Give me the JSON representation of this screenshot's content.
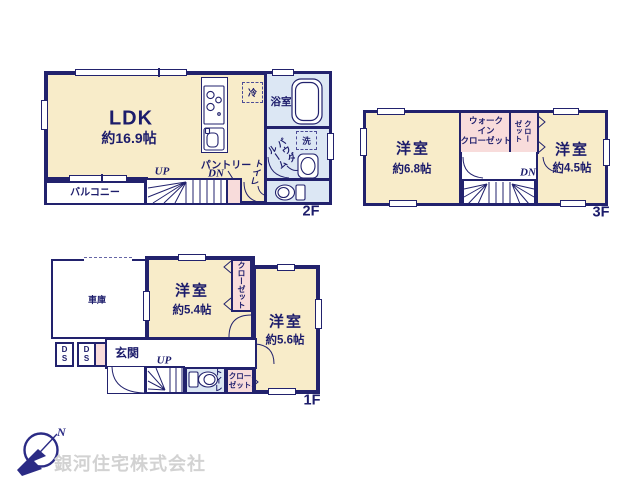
{
  "company": {
    "name": "銀河住宅株式会社"
  },
  "compass": {
    "north_label": "N"
  },
  "colors": {
    "wall_navy": "#22226d",
    "room_cream": "#f8ecc9",
    "wet_area_blue": "#dce7f4",
    "closet_pink": "#f8dcdb",
    "company_gray": "#d2d2d2"
  },
  "floor2": {
    "floor_label": "2F",
    "ldk_name": "LDK",
    "ldk_size": "約16.9帖",
    "balcony": "バルコニー",
    "up": "UP",
    "dn": "DN",
    "pantry": "パントリー",
    "toilet": "トイレ",
    "bath": "浴室",
    "fridge": "冷",
    "washer": "洗",
    "powder_line1": "パウダ",
    "powder_line2": "ルーム"
  },
  "floor3": {
    "floor_label": "3F",
    "room_a_name": "洋室",
    "room_a_size": "約6.8帖",
    "room_b_name": "洋室",
    "room_b_size": "約4.5帖",
    "wic_line1": "ウォーク",
    "wic_line2": "イン",
    "wic_line3": "クローゼット",
    "closet_col1": "クロー",
    "closet_col2": "ゼット",
    "dn": "DN"
  },
  "floor1": {
    "floor_label": "1F",
    "garage": "車庫",
    "room_a_name": "洋室",
    "room_a_size": "約5.4帖",
    "room_b_name": "洋室",
    "room_b_size": "約5.6帖",
    "entrance": "玄関",
    "ds1": "DS",
    "ds2": "DS",
    "up": "UP",
    "toilet": "トイレ",
    "closet_tall": "クローゼット",
    "closet_small_line1": "クロー",
    "closet_small_line2": "ゼット"
  }
}
